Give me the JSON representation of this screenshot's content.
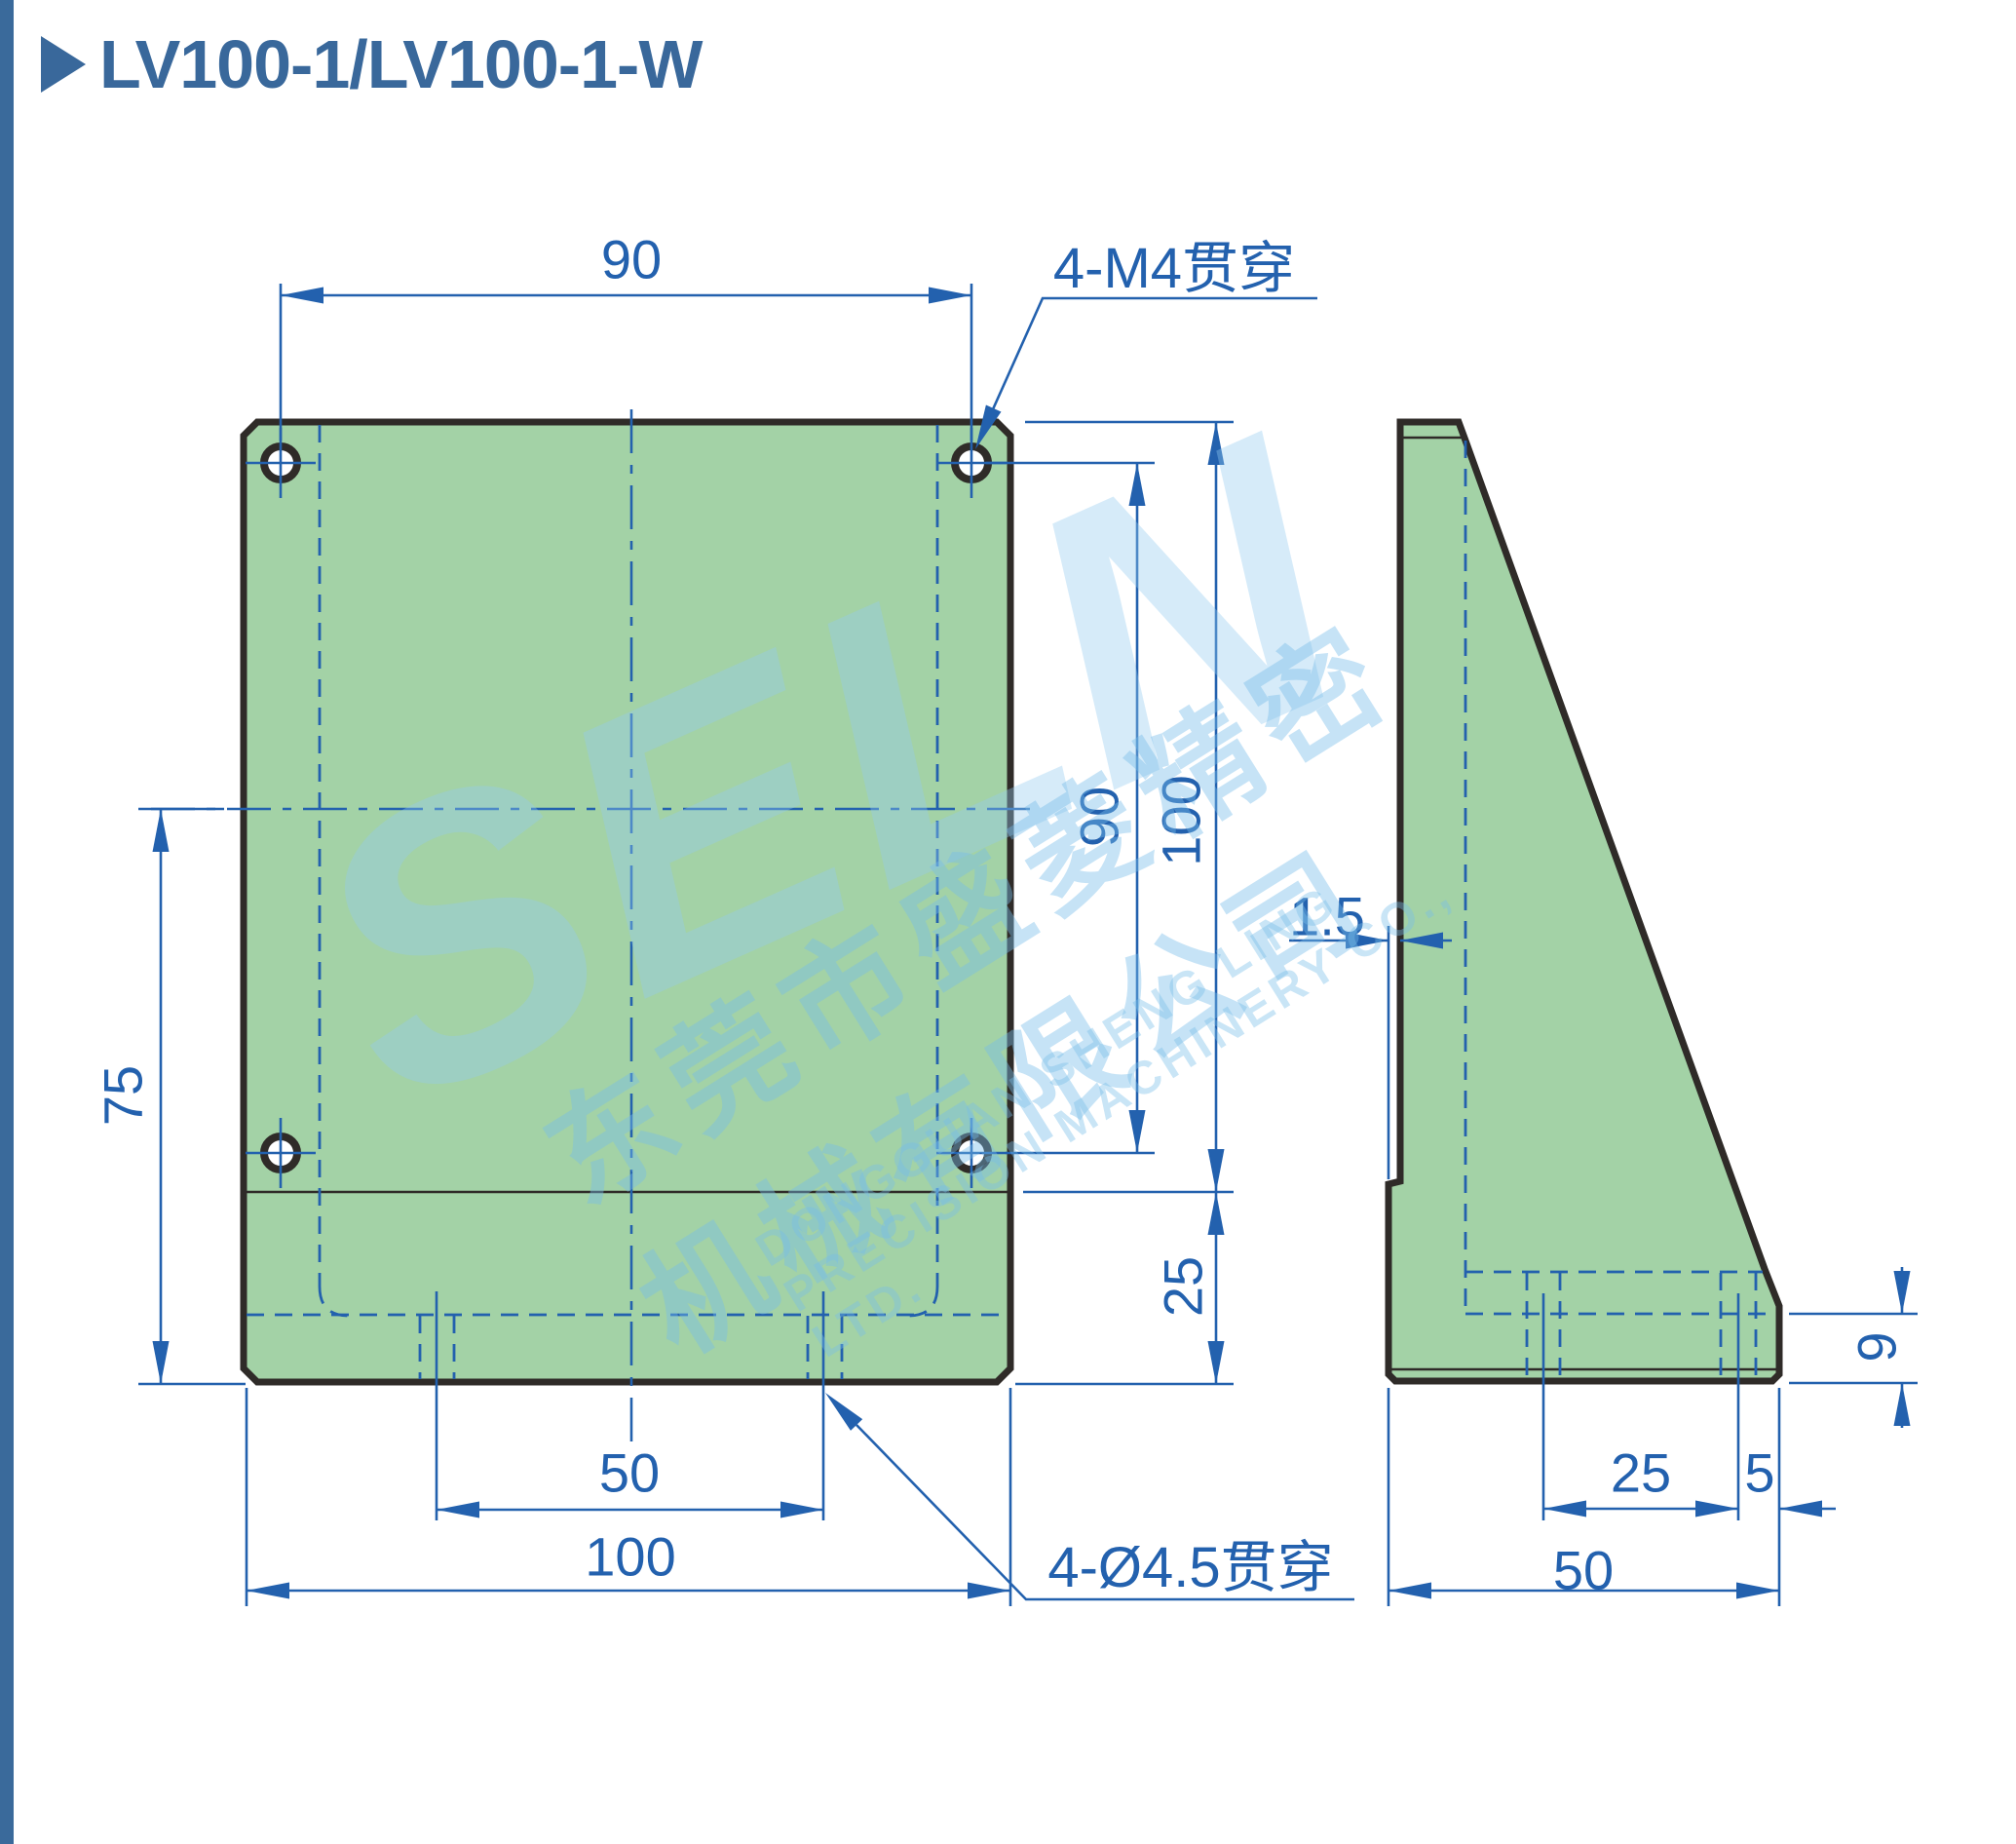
{
  "title": {
    "text": "LV100-1/LV100-1-W"
  },
  "callouts": {
    "m4": "4-M4贯穿",
    "drill": "4-Ø4.5贯穿"
  },
  "front_view": {
    "dim_top_hole_span": "90",
    "dim_left_height": "75",
    "dim_right_hole_span": "90",
    "dim_right_total_height": "100",
    "dim_right_base_height": "25",
    "dim_bottom_hole_span": "50",
    "dim_bottom_width": "100"
  },
  "side_view": {
    "dim_plate_step": "1.5",
    "dim_hole_span": "25",
    "dim_hole_edge": "5",
    "dim_depth": "50",
    "dim_base_lip": "9"
  },
  "watermark": {
    "brand": "SELN",
    "company_cn": "东莞市盛菱精密机械有限公司",
    "company_en": "DONGGUAN SHENG LING PRECISION MACHINERY CO., LTD."
  },
  "colors": {
    "part_fill": "#a3d2a6",
    "outline": "#2f2b28",
    "dimension_blue": "#2361ae",
    "title_blue": "#39689b",
    "stripe_blue": "#3a6a9b",
    "watermark_blue": "#cfe6f4"
  }
}
